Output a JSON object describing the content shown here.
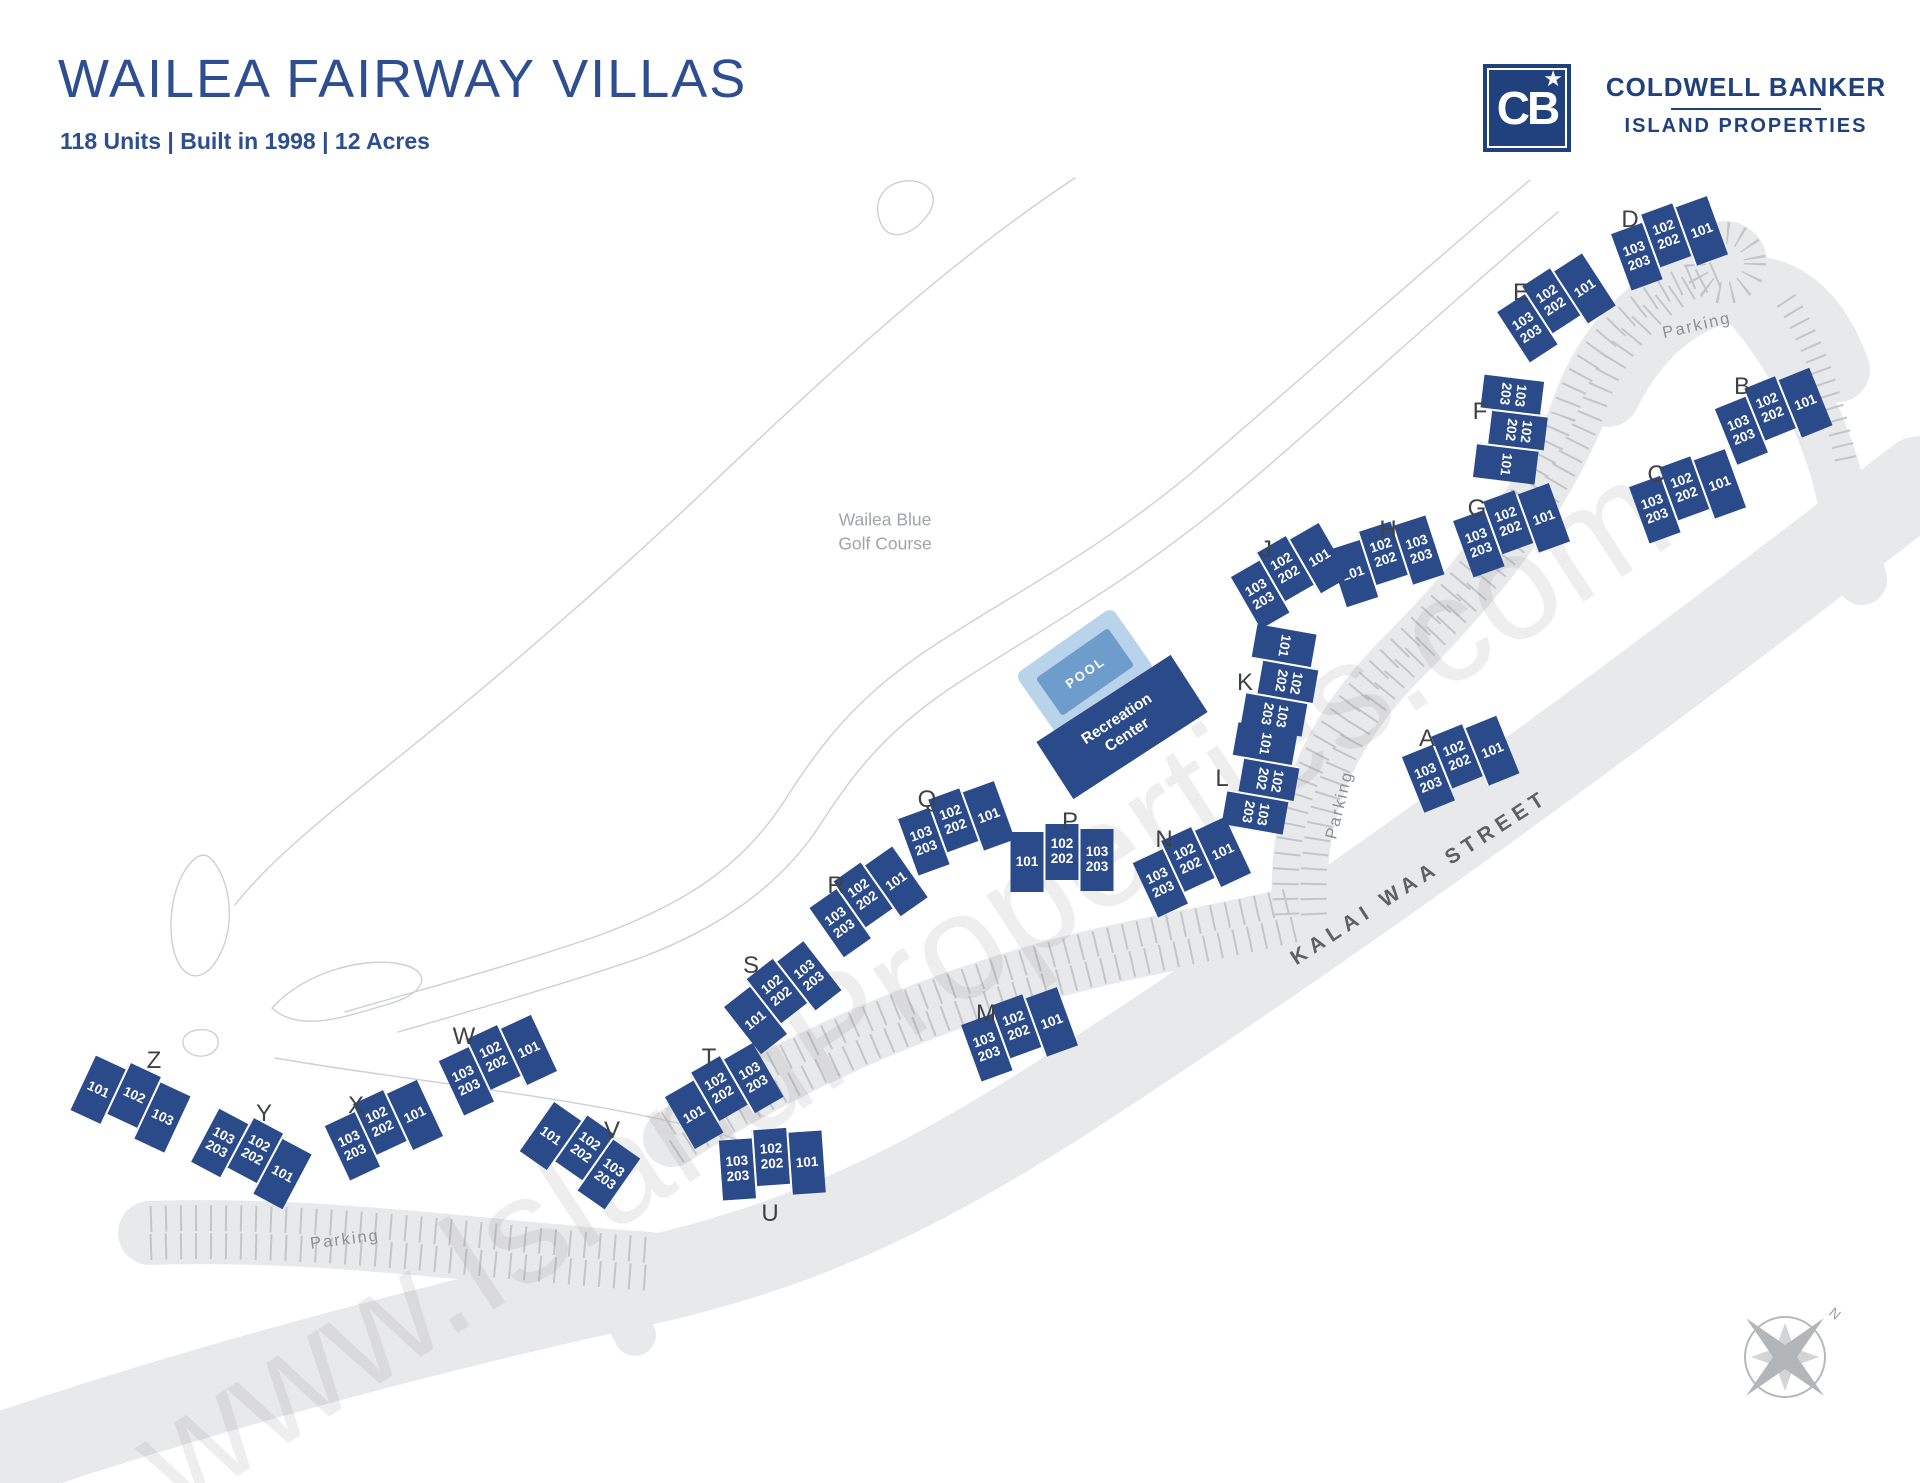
{
  "header": {
    "title": "WAILEA FAIRWAY VILLAS",
    "subtitle": "118 Units | Built in 1998 | 12 Acres",
    "logo": {
      "monogram": "CB",
      "star": "★",
      "brand_line1": "COLDWELL BANKER",
      "brand_line2": "ISLAND PROPERTIES"
    }
  },
  "map": {
    "watermark": "www.IslandProperties.com",
    "golf_course_label": {
      "line1": "Wailea Blue",
      "line2": "Golf Course"
    },
    "street_label": "KALAI WAA STREET",
    "parking_labels": [
      "Parking",
      "Parking",
      "Parking"
    ],
    "pool": {
      "label": "POOL"
    },
    "recreation_center": {
      "line1": "Recreation",
      "line2": "Center"
    },
    "compass": {
      "north": "N"
    },
    "colors": {
      "building": "#2b4a8a",
      "brand_navy": "#21407e",
      "title_blue": "#2d4e91",
      "pool_water": "#6f9dcb",
      "pool_deck": "#b9d3ea",
      "road": "#e8e9ea",
      "parking_tick": "#c3c5c8",
      "golf_line": "#cdd0d2"
    },
    "buildings": [
      {
        "label": "A",
        "x": 1459,
        "y": 761,
        "rot": -22,
        "lx": -32,
        "ly": -22,
        "sections": [
          [
            "103",
            "203"
          ],
          [
            "102",
            "202"
          ],
          [
            "101"
          ]
        ]
      },
      {
        "label": "B",
        "x": 1772,
        "y": 413,
        "rot": -22,
        "lx": -30,
        "ly": -26,
        "sections": [
          [
            "103",
            "203"
          ],
          [
            "102",
            "202"
          ],
          [
            "101"
          ]
        ]
      },
      {
        "label": "C",
        "x": 1686,
        "y": 493,
        "rot": -20,
        "lx": -30,
        "ly": -18,
        "sections": [
          [
            "103",
            "203"
          ],
          [
            "102",
            "202"
          ],
          [
            "101"
          ]
        ]
      },
      {
        "label": "D",
        "x": 1668,
        "y": 240,
        "rot": -20,
        "lx": -38,
        "ly": -20,
        "sections": [
          [
            "103",
            "203"
          ],
          [
            "102",
            "202"
          ],
          [
            "101"
          ]
        ]
      },
      {
        "label": "E",
        "x": 1554,
        "y": 305,
        "rot": -33,
        "lx": -33,
        "ly": -12,
        "sections": [
          [
            "103",
            "203"
          ],
          [
            "102",
            "202"
          ],
          [
            "101"
          ]
        ]
      },
      {
        "label": "F",
        "x": 1513,
        "y": 430,
        "rot": 97,
        "lx": -33,
        "ly": -18,
        "sections": [
          [
            "103",
            "203"
          ],
          [
            "102",
            "202"
          ],
          [
            "101"
          ]
        ]
      },
      {
        "label": "G",
        "x": 1510,
        "y": 527,
        "rot": -20,
        "lx": -33,
        "ly": -18,
        "sections": [
          [
            "103",
            "203"
          ],
          [
            "102",
            "202"
          ],
          [
            "101"
          ]
        ]
      },
      {
        "label": "H",
        "x": 1385,
        "y": 558,
        "rot": -18,
        "lx": 3,
        "ly": -28,
        "sections": [
          [
            "101"
          ],
          [
            "102",
            "202"
          ],
          [
            "103",
            "203"
          ]
        ]
      },
      {
        "label": "J",
        "x": 1288,
        "y": 573,
        "rot": -30,
        "lx": -22,
        "ly": -23,
        "sections": [
          [
            "103",
            "203"
          ],
          [
            "102",
            "202"
          ],
          [
            "101"
          ]
        ]
      },
      {
        "label": "K",
        "x": 1283,
        "y": 681,
        "rot": 100,
        "lx": -38,
        "ly": 2,
        "sections": [
          [
            "101"
          ],
          [
            "102",
            "202"
          ],
          [
            "103",
            "203"
          ]
        ]
      },
      {
        "label": "L",
        "x": 1264,
        "y": 779,
        "rot": 100,
        "lx": -42,
        "ly": 0,
        "sections": [
          [
            "101"
          ],
          [
            "102",
            "202"
          ],
          [
            "103",
            "203"
          ]
        ]
      },
      {
        "label": "M",
        "x": 1018,
        "y": 1031,
        "rot": -20,
        "lx": -32,
        "ly": -17,
        "sections": [
          [
            "103",
            "203"
          ],
          [
            "102",
            "202"
          ],
          [
            "101"
          ]
        ]
      },
      {
        "label": "N",
        "x": 1190,
        "y": 864,
        "rot": -25,
        "lx": -26,
        "ly": -24,
        "sections": [
          [
            "103",
            "203"
          ],
          [
            "102",
            "202"
          ],
          [
            "101"
          ]
        ]
      },
      {
        "label": "P",
        "x": 1062,
        "y": 857,
        "rot": 0,
        "lx": 8,
        "ly": -35,
        "sections": [
          [
            "101"
          ],
          [
            "102",
            "202"
          ],
          [
            "103",
            "203"
          ]
        ]
      },
      {
        "label": "Q",
        "x": 955,
        "y": 825,
        "rot": -20,
        "lx": -28,
        "ly": -25,
        "sections": [
          [
            "103",
            "203"
          ],
          [
            "102",
            "202"
          ],
          [
            "101"
          ]
        ]
      },
      {
        "label": "R",
        "x": 866,
        "y": 899,
        "rot": -35,
        "lx": -30,
        "ly": -13,
        "sections": [
          [
            "103",
            "203"
          ],
          [
            "102",
            "202"
          ],
          [
            "101"
          ]
        ]
      },
      {
        "label": "S",
        "x": 780,
        "y": 995,
        "rot": -38,
        "lx": -29,
        "ly": -29,
        "sections": [
          [
            "101"
          ],
          [
            "102",
            "202"
          ],
          [
            "103",
            "203"
          ]
        ]
      },
      {
        "label": "T",
        "x": 722,
        "y": 1093,
        "rot": -30,
        "lx": -13,
        "ly": -35,
        "sections": [
          [
            "101"
          ],
          [
            "102",
            "202"
          ],
          [
            "103",
            "203"
          ]
        ]
      },
      {
        "label": "U",
        "x": 772,
        "y": 1162,
        "rot": -4,
        "lx": -2,
        "ly": 52,
        "sections": [
          [
            "103",
            "203"
          ],
          [
            "102",
            "202"
          ],
          [
            "101"
          ]
        ]
      },
      {
        "label": "V",
        "x": 582,
        "y": 1152,
        "rot": 35,
        "lx": 30,
        "ly": -21,
        "sections": [
          [
            "101"
          ],
          [
            "102",
            "202"
          ],
          [
            "103",
            "203"
          ]
        ]
      },
      {
        "label": "W",
        "x": 496,
        "y": 1062,
        "rot": -25,
        "lx": -32,
        "ly": -25,
        "sections": [
          [
            "103",
            "203"
          ],
          [
            "102",
            "202"
          ],
          [
            "101"
          ]
        ]
      },
      {
        "label": "X",
        "x": 382,
        "y": 1127,
        "rot": -25,
        "lx": -26,
        "ly": -21,
        "sections": [
          [
            "103",
            "203"
          ],
          [
            "102",
            "202"
          ],
          [
            "101"
          ]
        ]
      },
      {
        "label": "Y",
        "x": 253,
        "y": 1155,
        "rot": 28,
        "lx": 11,
        "ly": -41,
        "sections": [
          [
            "103",
            "203"
          ],
          [
            "102",
            "202"
          ],
          [
            "101"
          ]
        ]
      },
      {
        "label": "Z",
        "x": 132,
        "y": 1100,
        "rot": 25,
        "lx": 22,
        "ly": -39,
        "sections": [
          [
            "101"
          ],
          [
            "102"
          ],
          [
            "103"
          ]
        ]
      }
    ]
  }
}
